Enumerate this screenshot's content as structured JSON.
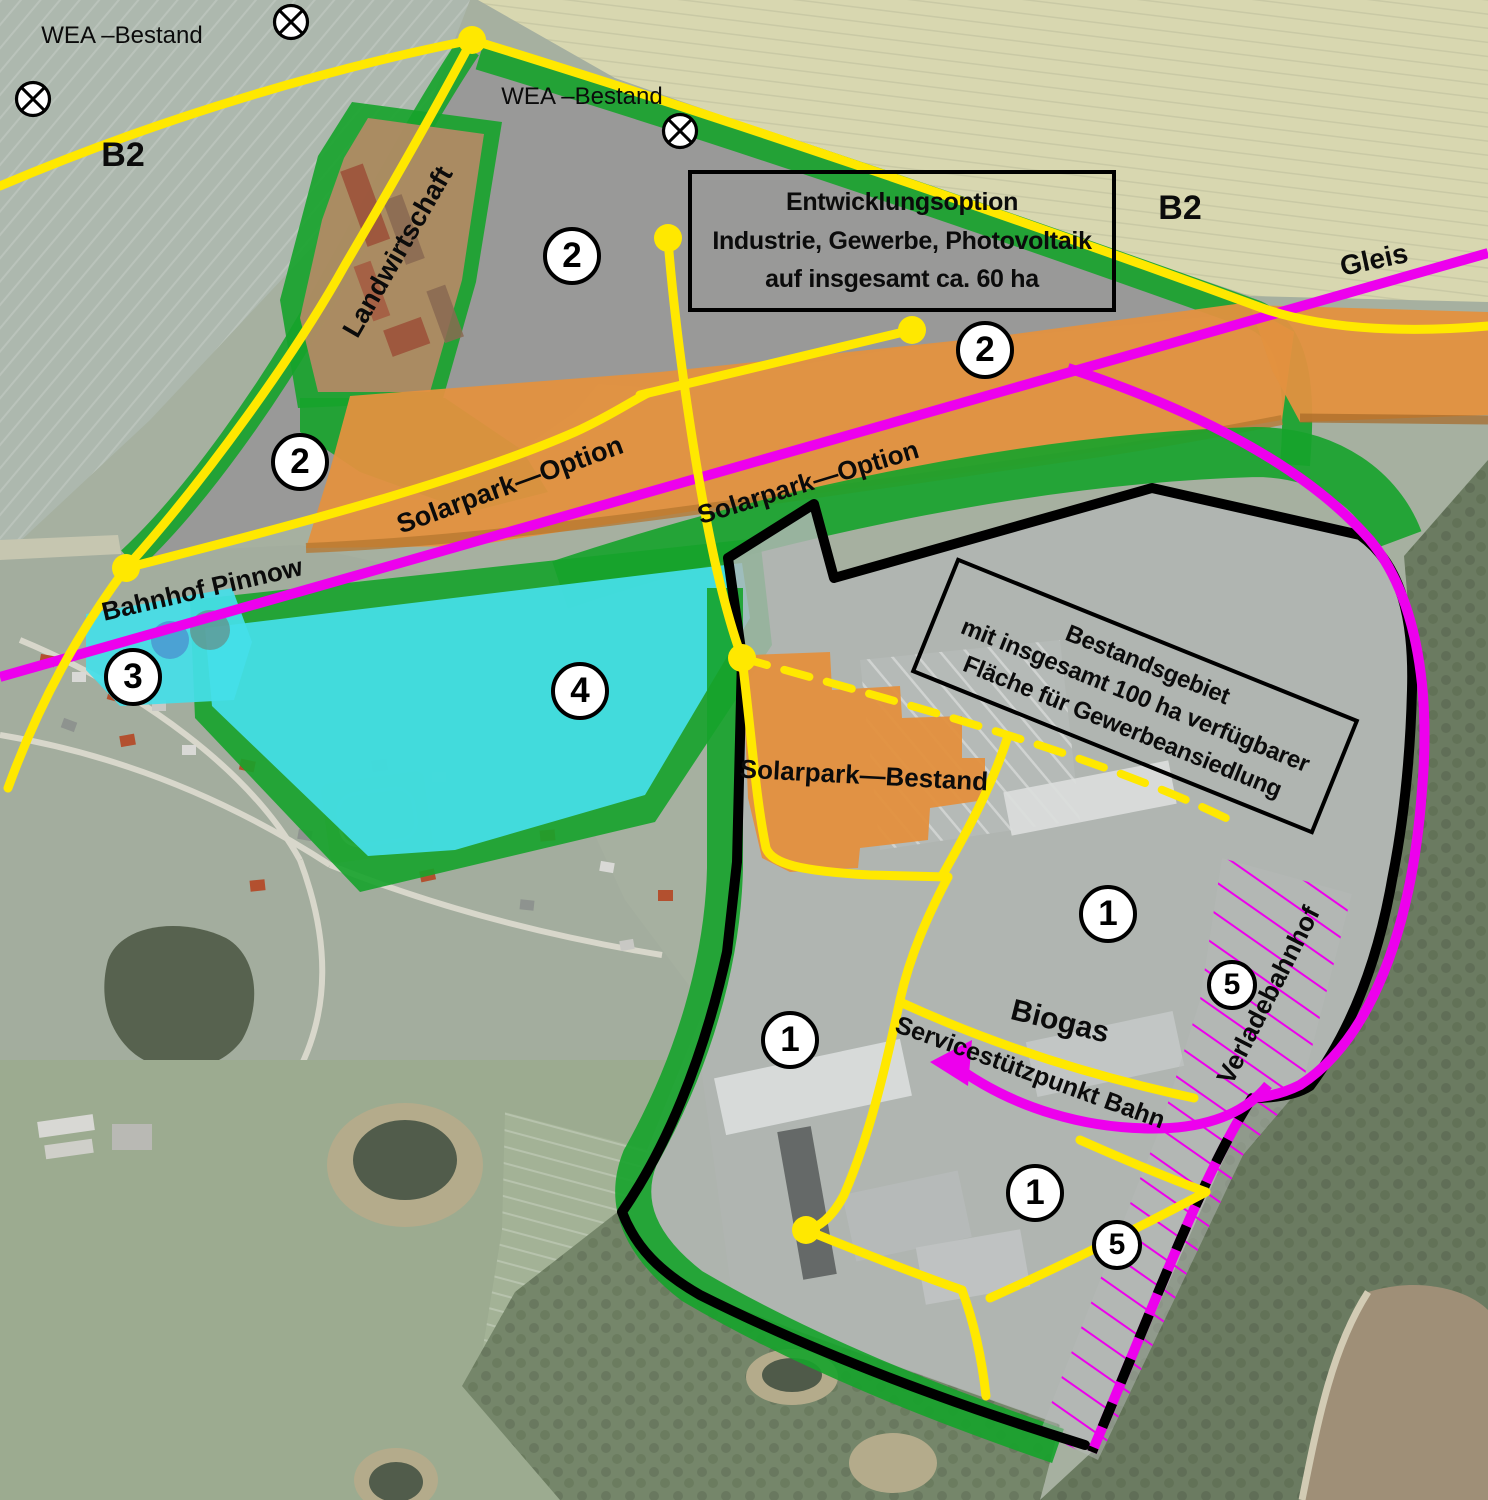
{
  "title": "Pinnow – Entwicklungsplan Industrie- und Gewerbegebiet (Luftbild mit Planoverlay)",
  "labels": {
    "wea1": "WEA –Bestand",
    "wea2": "WEA –Bestand",
    "b2_left": "B2",
    "b2_right": "B2",
    "gleis": "Gleis",
    "landwirtschaft": "Landwirtschaft",
    "solarpark_option_west": "Solarpark—Option",
    "solarpark_option_east": "Solarpark—Option",
    "bahnhof_pinnow": "Bahnhof Pinnow",
    "solarpark_bestand": "Solarpark—Bestand",
    "biogas": "Biogas",
    "service_bahn": "Servicestützpunkt Bahn",
    "verladebahnhof": "Verladebahnhof"
  },
  "info_boxes": {
    "entwicklungsoption": {
      "line1": "Entwicklungsoption",
      "line2": "Industrie, Gewerbe, Photovoltaik",
      "line3": "auf insgesamt ca. 60 ha"
    },
    "bestandsgebiet": {
      "line1": "Bestandsgebiet",
      "line2": "mit insgesamt 100 ha verfügbarer",
      "line3": "Fläche für Gewerbeansiedlung"
    }
  },
  "zone_markers": [
    {
      "label": "2"
    },
    {
      "label": "2"
    },
    {
      "label": "2"
    },
    {
      "label": "3"
    },
    {
      "label": "4"
    },
    {
      "label": "1"
    },
    {
      "label": "1"
    },
    {
      "label": "1"
    },
    {
      "label": "5"
    },
    {
      "label": "5"
    }
  ],
  "symbols": {
    "wind_turbine": "crossed-circle (WEA Bestand wind turbine)",
    "junction_dot": "yellow road junction dot"
  },
  "colors": {
    "road_yellow": "#ffe800",
    "rail_magenta": "#ed00ed",
    "greenery": "#16a32b",
    "solarpark_orange": "#e3913f",
    "zone4_cyan": "#45dfe8",
    "boundary_black": "#000000",
    "development_gray": "#989898"
  }
}
